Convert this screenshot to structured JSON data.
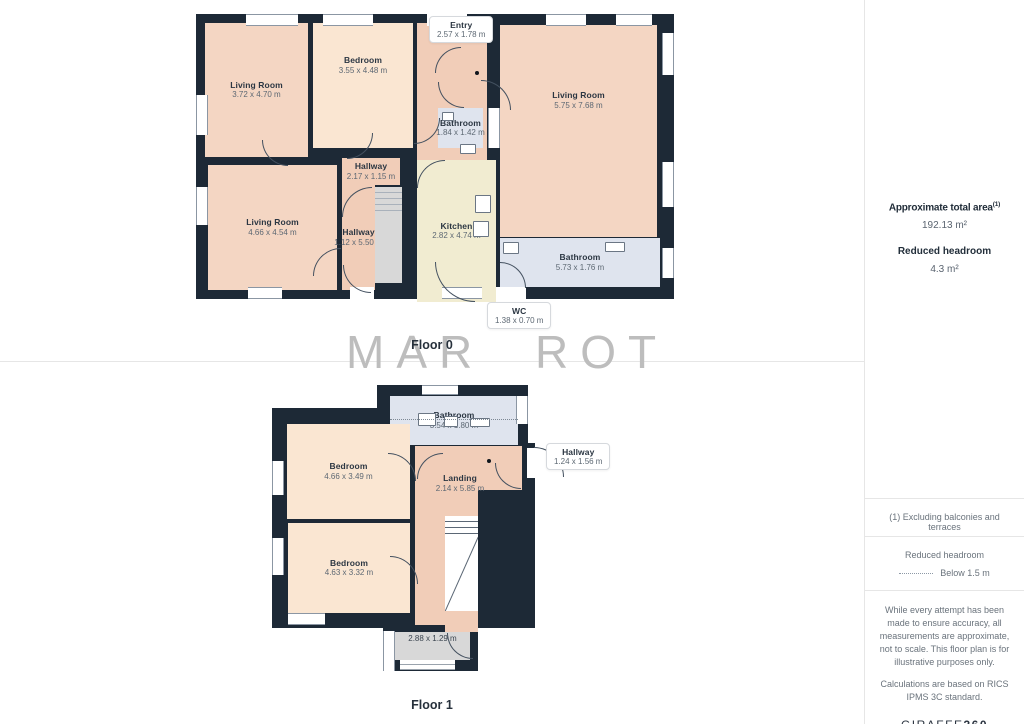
{
  "watermark": {
    "text": "MAR ROT"
  },
  "floors": {
    "floor0": {
      "label": "Floor 0",
      "rooms": {
        "living_top_left": {
          "name": "Living Room",
          "dims": "3.72 x 4.70 m"
        },
        "bedroom": {
          "name": "Bedroom",
          "dims": "3.55 x 4.48 m"
        },
        "bathroom_small": {
          "name": "Bathroom",
          "dims": "1.84 x 1.42 m"
        },
        "living_right": {
          "name": "Living Room",
          "dims": "5.75 x 7.68 m"
        },
        "hallway_top": {
          "name": "Hallway",
          "dims": "2.17 x 1.15 m"
        },
        "living_bottom_left": {
          "name": "Living Room",
          "dims": "4.66 x 4.54 m"
        },
        "hallway_vertical": {
          "name": "Hallway",
          "dims": "1.12 x 5.50 m"
        },
        "kitchen": {
          "name": "Kitchen",
          "dims": "2.82 x 4.74 m"
        },
        "bathroom_wide": {
          "name": "Bathroom",
          "dims": "5.73 x 1.76 m"
        }
      },
      "callouts": {
        "entry": {
          "name": "Entry",
          "dims": "2.57 x 1.78 m"
        },
        "wc": {
          "name": "WC",
          "dims": "1.38 x 0.70 m"
        }
      }
    },
    "floor1": {
      "label": "Floor 1",
      "rooms": {
        "bathroom": {
          "name": "Bathroom",
          "dims": "3.54 x 1.80 m"
        },
        "bedroom_upper": {
          "name": "Bedroom",
          "dims": "4.66 x 3.49 m"
        },
        "landing": {
          "name": "Landing",
          "dims": "2.14 x 5.85 m"
        },
        "bedroom_lower": {
          "name": "Bedroom",
          "dims": "4.63 x 3.32 m"
        },
        "porch": {
          "dims": "2.88 x 1.29 m"
        }
      },
      "callouts": {
        "hallway": {
          "name": "Hallway",
          "dims": "1.24 x 1.56 m"
        }
      }
    }
  },
  "sidebar": {
    "total_area_label": "Approximate total area",
    "total_area_marker": "(1)",
    "total_area_value": "192.13 m²",
    "reduced_headroom_label": "Reduced headroom",
    "reduced_headroom_value": "4.3 m²",
    "footnote": "(1) Excluding balconies and terraces",
    "legend_label": "Reduced headroom",
    "legend_value": "Below 1.5 m",
    "disclaimer_1": "While every attempt has been made to ensure accuracy, all measurements are approximate, not to scale. This floor plan is for illustrative purposes only.",
    "disclaimer_2": "Calculations are based on RICS IPMS 3C standard.",
    "logo_primary": "GIRAFFE",
    "logo_secondary": "360"
  },
  "colors": {
    "wall": "#1d2936",
    "room-peach": "#f4d6c3",
    "room-salmon": "#f1cdb8",
    "room-cream": "#fae6d2",
    "room-kitchen": "#f1ecd1",
    "room-bath": "#dfe4ee",
    "room-gray": "#d8d8d8",
    "line": "#43505f",
    "divider": "#e6e6e6",
    "watermark": "#bdbdbd",
    "text-dark": "#222e3a",
    "text-dim": "#5d6873",
    "text-gray": "#6a737c"
  }
}
